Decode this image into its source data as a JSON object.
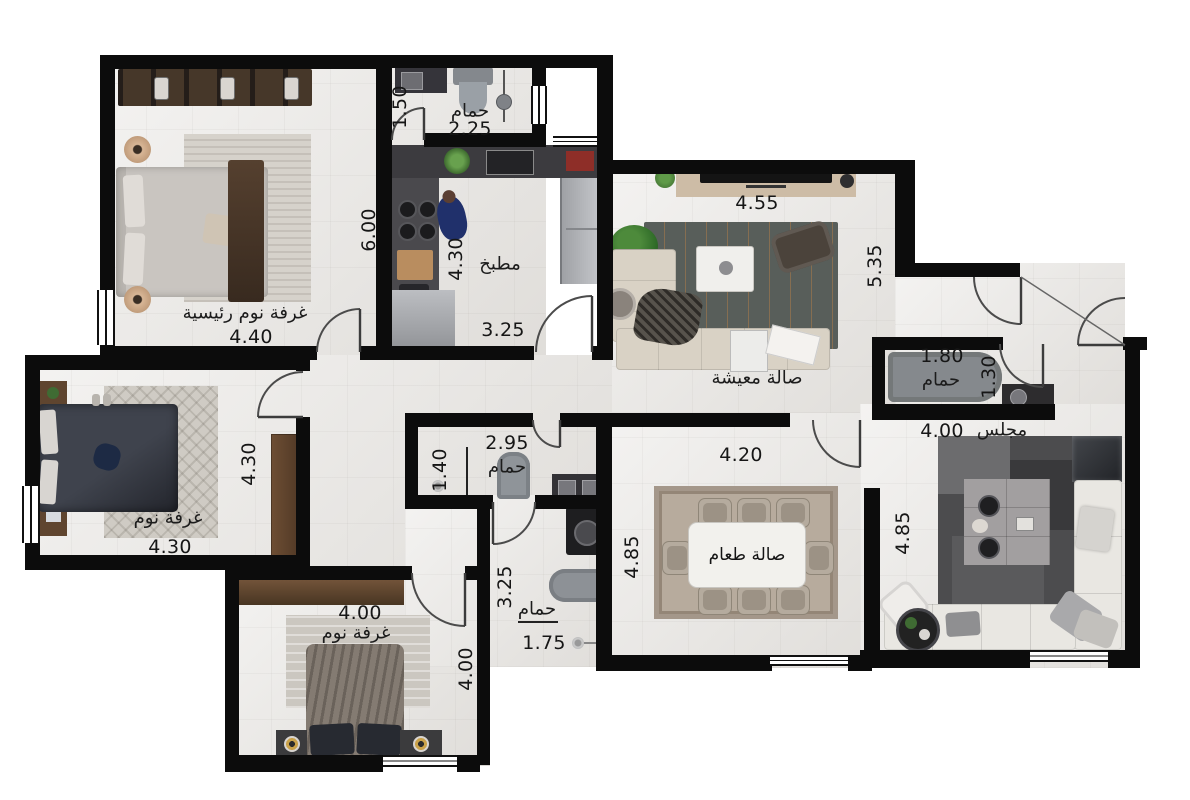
{
  "plan_title": "apartment-floor-plan",
  "rooms": {
    "master": {
      "name": "غرفة نوم رئيسية",
      "w": "4.40",
      "h": "6.00"
    },
    "bath1": {
      "name": "حمام",
      "w": "2.25",
      "door": "1.50"
    },
    "kitchen": {
      "name": "مطبخ",
      "w": "3.25",
      "h": "4.30"
    },
    "living": {
      "name": "صالة معيشة",
      "w": "4.55",
      "h": "5.35"
    },
    "bathR": {
      "name": "حمام",
      "w": "1.80",
      "h": "1.30"
    },
    "majlis": {
      "name": "مجلس",
      "w": "4.00",
      "h": "4.85"
    },
    "dining": {
      "name": "صالة طعام",
      "w": "4.20",
      "h": "4.85"
    },
    "bathA": {
      "name": "حمام",
      "w": "2.95",
      "h": "1.40"
    },
    "bathB": {
      "name": "حمام",
      "w": "1.75",
      "h": "3.25"
    },
    "bedroom2": {
      "name": "غرفة نوم",
      "w": "4.30",
      "h": "4.30"
    },
    "bedroom3": {
      "name": "غرفة نوم",
      "w": "4.00",
      "h": "4.00"
    }
  },
  "colors": {
    "wall": "#0c0c0c",
    "floor": "#e9e7e4",
    "wood": "#6b4c33",
    "sofa_beige": "#d9d2c5",
    "sofa_white": "#e9e7e2",
    "duvet_dark": "#33363e",
    "rug_charcoal": "#585e5a",
    "fixture_gray": "#8f9499"
  }
}
